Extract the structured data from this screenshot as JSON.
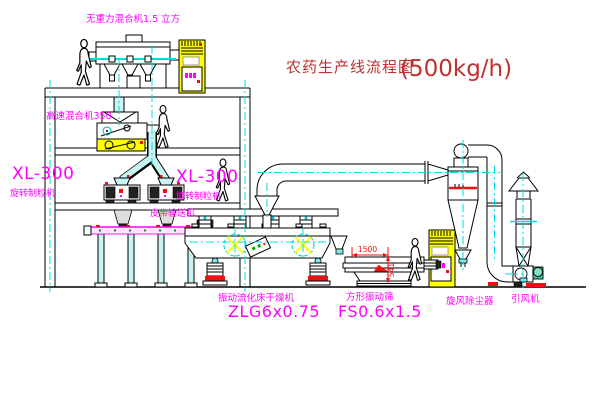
{
  "title": {
    "text": "农药生产线流程图",
    "capacity": "(500kg/h)"
  },
  "equipment_labels": {
    "gravity_mixer": "无重力混合机1.5 立方",
    "high_speed_mixer": "高速混合机350",
    "granulator_left_model": "XL-300",
    "granulator_left_name": "旋转制粒机",
    "granulator_right_model": "XL-300",
    "granulator_right_name": "旋转制粒机",
    "belt_conveyor": "皮带输送机",
    "fluid_bed_dryer_name": "振动流化床干燥机",
    "fluid_bed_dryer_model": "ZLG6x0.75",
    "vibrating_screen_name": "方形振动筛",
    "vibrating_screen_model": "FS0.6x1.5",
    "cyclone": "旋风除尘器",
    "draft_fan": "引风机"
  },
  "dimensions": {
    "screen_length": "1500",
    "screen_height": "541"
  },
  "colors": {
    "background": "#FFFFFF",
    "line": "#000000",
    "centerline_cyan": "#00DCDC",
    "pipe_fill_cyan": "#C7F3F3",
    "cabinet_yellow": "#FFFF00",
    "label_magenta": "#FF00FF",
    "title_red": "#C03030",
    "dimension_red": "#EE1111",
    "fan_teal": "#3FC8A8"
  },
  "icons": {
    "person_figure": "walking-worker-silhouette"
  }
}
